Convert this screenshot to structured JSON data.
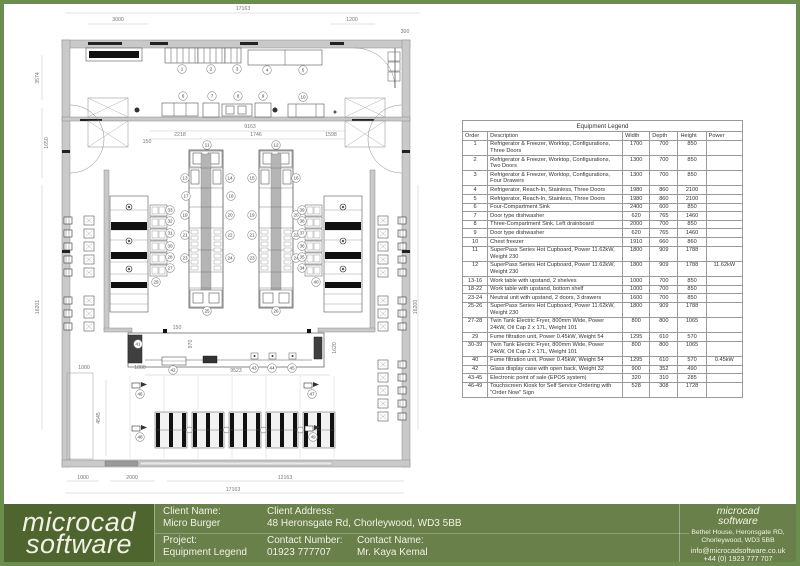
{
  "page": {
    "border_color": "#6b8e4e",
    "background": "#ffffff"
  },
  "legend_table": {
    "title": "Equipment Legend",
    "columns": [
      "Order",
      "Description",
      "Width",
      "Depth",
      "Height",
      "Power"
    ],
    "rows": [
      [
        "1",
        "Refrigerator & Freezer, Worktop, Configurations, Three Doors",
        "1700",
        "700",
        "850",
        ""
      ],
      [
        "2",
        "Refrigerator & Freezer, Worktop, Configurations, Two Doors",
        "1300",
        "700",
        "850",
        ""
      ],
      [
        "3",
        "Refrigerator & Freezer, Worktop, Configurations, Four Drawers",
        "1300",
        "700",
        "850",
        ""
      ],
      [
        "4",
        "Refrigerator, Reach-In, Stainless, Three Doors",
        "1980",
        "860",
        "2100",
        ""
      ],
      [
        "5",
        "Refrigerator, Reach-In, Stainless, Three Doors",
        "1980",
        "860",
        "2100",
        ""
      ],
      [
        "6",
        "Four-Compartment Sink",
        "2400",
        "600",
        "850",
        ""
      ],
      [
        "7",
        "Door type dishwasher",
        "620",
        "765",
        "1460",
        ""
      ],
      [
        "8",
        "Three-Compartment Sink, Left drainboard",
        "2000",
        "700",
        "850",
        ""
      ],
      [
        "9",
        "Door type dishwasher",
        "620",
        "765",
        "1460",
        ""
      ],
      [
        "10",
        "Chest freezer",
        "1910",
        "660",
        "860",
        ""
      ],
      [
        "11",
        "SuperPass Series Hot Cupboard, Power 11.62kW, Weight 230",
        "1800",
        "909",
        "1788",
        ""
      ],
      [
        "12",
        "SuperPass Series Hot Cupboard, Power 11.62kW, Weight 230",
        "1800",
        "909",
        "1788",
        "11.62kW"
      ],
      [
        "13-16",
        "Work table with upstand, 2 shelves",
        "1000",
        "700",
        "850",
        ""
      ],
      [
        "18-22",
        "Work table with upstand, bottom shelf",
        "1000",
        "700",
        "850",
        ""
      ],
      [
        "23-24",
        "Neutral unit with upstand, 2 doors, 3 drawers",
        "1600",
        "700",
        "850",
        ""
      ],
      [
        "25-26",
        "SuperPass Series Hot Cupboard, Power 11.62kW, Weight 230",
        "1800",
        "909",
        "1788",
        ""
      ],
      [
        "27-28",
        "Twin Tank Electric Fryer, 800mm Wide, Power 24kW, Oil Cap 2 x 17L, Weight 101",
        "800",
        "800",
        "1065",
        ""
      ],
      [
        "29",
        "Fume filtration unit, Power 0.45kW, Weight 54",
        "1295",
        "610",
        "570",
        ""
      ],
      [
        "30-39",
        "Twin Tank Electric Fryer, 800mm Wide, Power 24kW, Oil Cap 2 x 17L, Weight 101",
        "800",
        "800",
        "1065",
        ""
      ],
      [
        "40",
        "Fume filtration unit, Power 0.45kW, Weight 54",
        "1295",
        "610",
        "570",
        "0.45kW"
      ],
      [
        "42",
        "Glass display case with open back, Weight 32",
        "900",
        "352",
        "490",
        ""
      ],
      [
        "43-45",
        "Electronic point of sale (EPOS system)",
        "320",
        "310",
        "285",
        ""
      ],
      [
        "46-49",
        "Touchscreen Kiosk for Self Service Ordering with \"Order Now\" Sign",
        "528",
        "308",
        "1728",
        ""
      ]
    ]
  },
  "floor_plan": {
    "dimensions": [
      {
        "text": "17163",
        "x": 243,
        "y": 10,
        "rot": 0
      },
      {
        "text": "3000",
        "x": 118,
        "y": 21,
        "rot": 0
      },
      {
        "text": "1200",
        "x": 352,
        "y": 21,
        "rot": 0
      },
      {
        "text": "300",
        "x": 405,
        "y": 33,
        "rot": 0
      },
      {
        "text": "9163",
        "x": 250,
        "y": 128,
        "rot": 0
      },
      {
        "text": "2218",
        "x": 180,
        "y": 136,
        "rot": 0
      },
      {
        "text": "1746",
        "x": 256,
        "y": 136,
        "rot": 0
      },
      {
        "text": "1598",
        "x": 331,
        "y": 136,
        "rot": 0
      },
      {
        "text": "150",
        "x": 147,
        "y": 143,
        "rot": 0
      },
      {
        "text": "3574",
        "x": 39,
        "y": 78,
        "rot": -90
      },
      {
        "text": "1650",
        "x": 48,
        "y": 143,
        "rot": -90
      },
      {
        "text": "16201",
        "x": 39,
        "y": 307,
        "rot": -90
      },
      {
        "text": "16200",
        "x": 417,
        "y": 307,
        "rot": -90
      },
      {
        "text": "150",
        "x": 177,
        "y": 329,
        "rot": 0
      },
      {
        "text": "970",
        "x": 192,
        "y": 344,
        "rot": -90
      },
      {
        "text": "1620",
        "x": 336,
        "y": 348,
        "rot": -90
      },
      {
        "text": "1000",
        "x": 84,
        "y": 369,
        "rot": 0
      },
      {
        "text": "1000",
        "x": 140,
        "y": 369,
        "rot": 0
      },
      {
        "text": "9523",
        "x": 236,
        "y": 372,
        "rot": 0
      },
      {
        "text": "4545",
        "x": 100,
        "y": 418,
        "rot": -90
      },
      {
        "text": "1000",
        "x": 83,
        "y": 479,
        "rot": 0
      },
      {
        "text": "2000",
        "x": 132,
        "y": 479,
        "rot": 0
      },
      {
        "text": "12163",
        "x": 285,
        "y": 479,
        "rot": 0
      },
      {
        "text": "17163",
        "x": 233,
        "y": 491,
        "rot": 0
      }
    ],
    "item_markers": [
      {
        "n": "1",
        "x": 182,
        "y": 69
      },
      {
        "n": "2",
        "x": 211,
        "y": 69
      },
      {
        "n": "3",
        "x": 237,
        "y": 69
      },
      {
        "n": "4",
        "x": 267,
        "y": 70
      },
      {
        "n": "5",
        "x": 303,
        "y": 70
      },
      {
        "n": "6",
        "x": 183,
        "y": 96
      },
      {
        "n": "7",
        "x": 212,
        "y": 96
      },
      {
        "n": "8",
        "x": 238,
        "y": 96
      },
      {
        "n": "9",
        "x": 263,
        "y": 96
      },
      {
        "n": "10",
        "x": 303,
        "y": 97
      },
      {
        "n": "11",
        "x": 207,
        "y": 145
      },
      {
        "n": "12",
        "x": 276,
        "y": 145
      },
      {
        "n": "13",
        "x": 185,
        "y": 178
      },
      {
        "n": "14",
        "x": 230,
        "y": 178
      },
      {
        "n": "15",
        "x": 252,
        "y": 178
      },
      {
        "n": "16",
        "x": 296,
        "y": 178
      },
      {
        "n": "17",
        "x": 186,
        "y": 196
      },
      {
        "n": "18",
        "x": 231,
        "y": 196
      },
      {
        "n": "19",
        "x": 185,
        "y": 215
      },
      {
        "n": "20",
        "x": 230,
        "y": 215
      },
      {
        "n": "21",
        "x": 185,
        "y": 235
      },
      {
        "n": "22",
        "x": 230,
        "y": 235
      },
      {
        "n": "23",
        "x": 185,
        "y": 258
      },
      {
        "n": "24",
        "x": 230,
        "y": 258
      },
      {
        "n": "19",
        "x": 252,
        "y": 215
      },
      {
        "n": "20",
        "x": 296,
        "y": 215
      },
      {
        "n": "21",
        "x": 252,
        "y": 235
      },
      {
        "n": "22",
        "x": 296,
        "y": 235
      },
      {
        "n": "23",
        "x": 252,
        "y": 258
      },
      {
        "n": "24",
        "x": 296,
        "y": 258
      },
      {
        "n": "25",
        "x": 207,
        "y": 311
      },
      {
        "n": "26",
        "x": 276,
        "y": 311
      },
      {
        "n": "33",
        "x": 170,
        "y": 210
      },
      {
        "n": "32",
        "x": 170,
        "y": 221
      },
      {
        "n": "31",
        "x": 170,
        "y": 233
      },
      {
        "n": "30",
        "x": 170,
        "y": 246
      },
      {
        "n": "28",
        "x": 170,
        "y": 257
      },
      {
        "n": "27",
        "x": 170,
        "y": 268
      },
      {
        "n": "29",
        "x": 156,
        "y": 282
      },
      {
        "n": "39",
        "x": 302,
        "y": 210
      },
      {
        "n": "38",
        "x": 302,
        "y": 221
      },
      {
        "n": "37",
        "x": 302,
        "y": 233
      },
      {
        "n": "36",
        "x": 302,
        "y": 246
      },
      {
        "n": "35",
        "x": 302,
        "y": 257
      },
      {
        "n": "34",
        "x": 302,
        "y": 268
      },
      {
        "n": "40",
        "x": 316,
        "y": 282
      },
      {
        "n": "41",
        "x": 138,
        "y": 344
      },
      {
        "n": "42",
        "x": 173,
        "y": 370
      },
      {
        "n": "43",
        "x": 254,
        "y": 368
      },
      {
        "n": "44",
        "x": 272,
        "y": 368
      },
      {
        "n": "45",
        "x": 292,
        "y": 368
      },
      {
        "n": "46",
        "x": 140,
        "y": 394
      },
      {
        "n": "47",
        "x": 312,
        "y": 394
      },
      {
        "n": "48",
        "x": 140,
        "y": 437
      },
      {
        "n": "49",
        "x": 313,
        "y": 437
      }
    ]
  },
  "title_block": {
    "logo_line1": "microcad",
    "logo_line2": "software",
    "fields": [
      {
        "label": "Client Name:",
        "value": "Micro Burger"
      },
      {
        "label": "Client Address:",
        "value": "48 Heronsgate Rd, Chorleywood, WD3 5BB"
      },
      {
        "label": "Project:",
        "value": "Equipment Legend"
      },
      {
        "label": "Contact Number:",
        "value": "01923 777707"
      },
      {
        "label": "Contact Name:",
        "value": "Mr. Kaya Kemal"
      }
    ],
    "company": {
      "name_line1": "microcad",
      "name_line2": "software",
      "address_line1": "Bethel House, Heronsgate RD,",
      "address_line2": "Chorleywood, WD3 5BB",
      "email": "info@microcadsoftware.co.uk",
      "phone": "+44 (0) 1923 777 707"
    }
  }
}
